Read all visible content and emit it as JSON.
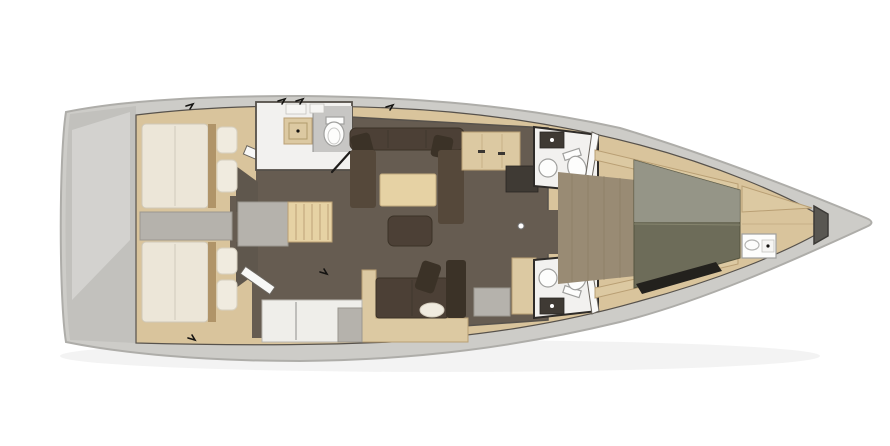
{
  "scene": {
    "type": "sailing-yacht-interior-floor-plan",
    "orientation_bow": "right",
    "orientation_stern": "left",
    "background": "#ffffff"
  },
  "palette": {
    "background": "#ffffff",
    "hull": "#cdccc8",
    "hull_edge": "#aeada9",
    "deck_wood": "#d9c49c",
    "wood_trim": "#b99f74",
    "salon_floor": "#665c51",
    "wardrobe": "#5f574d",
    "sofa": "#4c4036",
    "sofa_dark": "#3b3227",
    "sofa_mid": "#55483a",
    "table_wood": "#e6d2a4",
    "bed_cream": "#ece6d8",
    "bed_trim": "#b09468",
    "pillow": "#f0ebdf",
    "bench_gray": "#b5b2ac",
    "counter_wood": "#dcc9a2",
    "counter_white": "#efeeea",
    "bath_white": "#f2f1ef",
    "bath_gray": "#c7c6c4",
    "fixture_white": "#fdfdfc",
    "fixture_stroke": "#a0a09e",
    "wall_dark": "#57524c",
    "head_wall": "#2e2b28",
    "berth_olive": "#6d6c59",
    "berth_dark": "#23211d",
    "locker_gray": "#595752",
    "plank_floor": "#998b74",
    "dark_unit": "#3f3a34",
    "mark_black": "#141311"
  },
  "components": {
    "hull": "boat hull outline, bow right, transom left",
    "aft_cabin_port": "double bed with two pillows and bench",
    "aft_cabin_starboard": "double bed with two pillows",
    "aft_head": "shower, vanity sink, toilet",
    "companionway": "steps and engine box",
    "salon": "U-sofa, dining table, ottoman, lower settee",
    "galley": "counters, cabinets, sink unit",
    "nav_station": "desk and seat",
    "forward_head_port": "toilet, round sink, cabinet",
    "forward_head_starboard": "toilet, round sink, cabinet",
    "forward_cabin": "olive V-berth with side shelves",
    "bow": "washbasin console and anchor locker"
  }
}
